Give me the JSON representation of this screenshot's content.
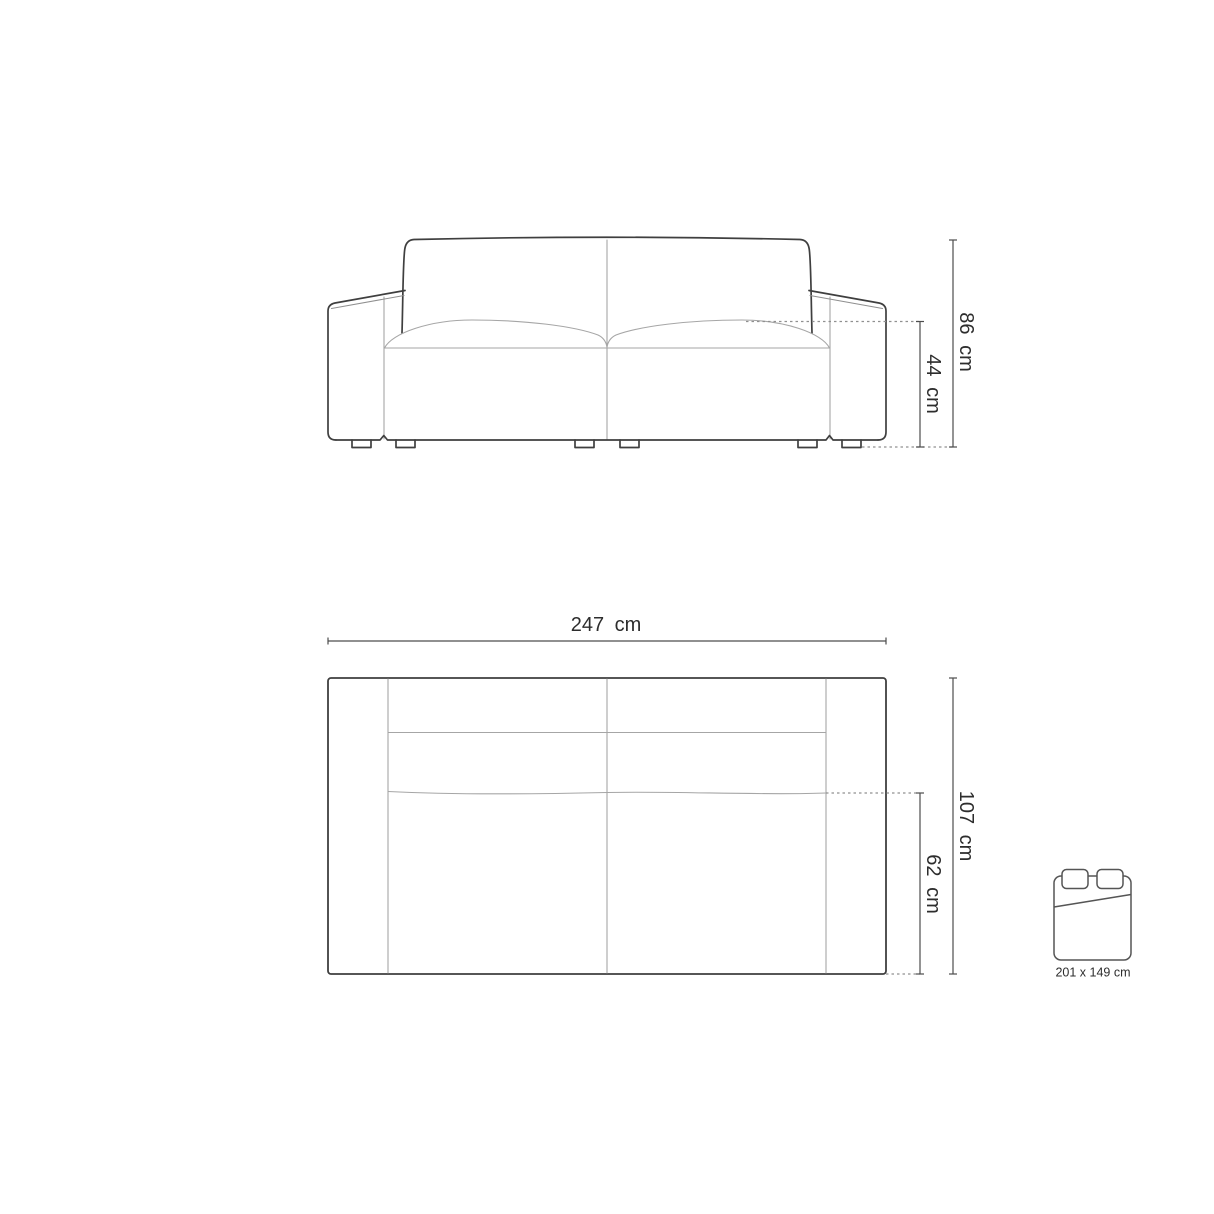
{
  "diagram": {
    "type": "sofa-technical-drawing",
    "background": "#ffffff"
  },
  "colors": {
    "outline": "#3f3f3f",
    "seam": "#a6a6a6",
    "dimension_line": "#4d4d4d",
    "dotted_line": "#909090",
    "text": "#2d2d2d"
  },
  "dimensions": {
    "total_height": "86 cm",
    "seat_height": "44 cm",
    "total_width": "247 cm",
    "total_depth": "107 cm",
    "seat_depth": "62 cm"
  },
  "sleeping_area": {
    "icon": "bed-icon",
    "label": "201 x 149 cm"
  }
}
